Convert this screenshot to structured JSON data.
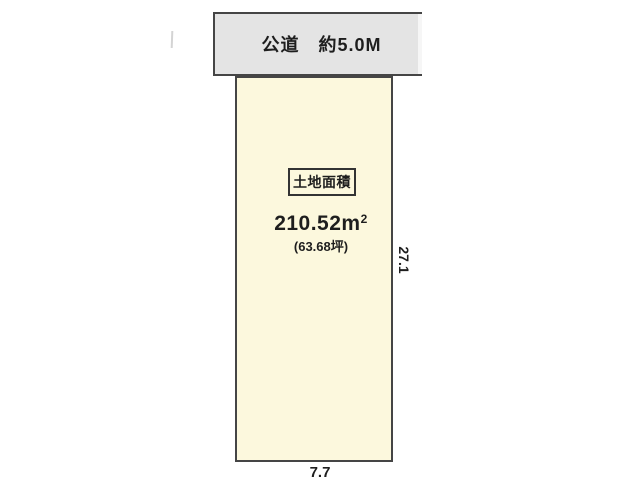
{
  "diagram": {
    "road": {
      "label": "公道　約5.0M"
    },
    "plot": {
      "area_box_label": "土地面積",
      "area_value": "210.52",
      "area_unit_base": "m",
      "area_unit_sup": "2",
      "area_tsubo": "(63.68坪)"
    },
    "dimensions": {
      "right_side": "27.1",
      "bottom_side": "7.7"
    }
  },
  "colors": {
    "plot_fill": "#fcf8dd",
    "road_fill": "#e4e4e4",
    "outline": "#454545",
    "text": "#1e1e1e"
  }
}
